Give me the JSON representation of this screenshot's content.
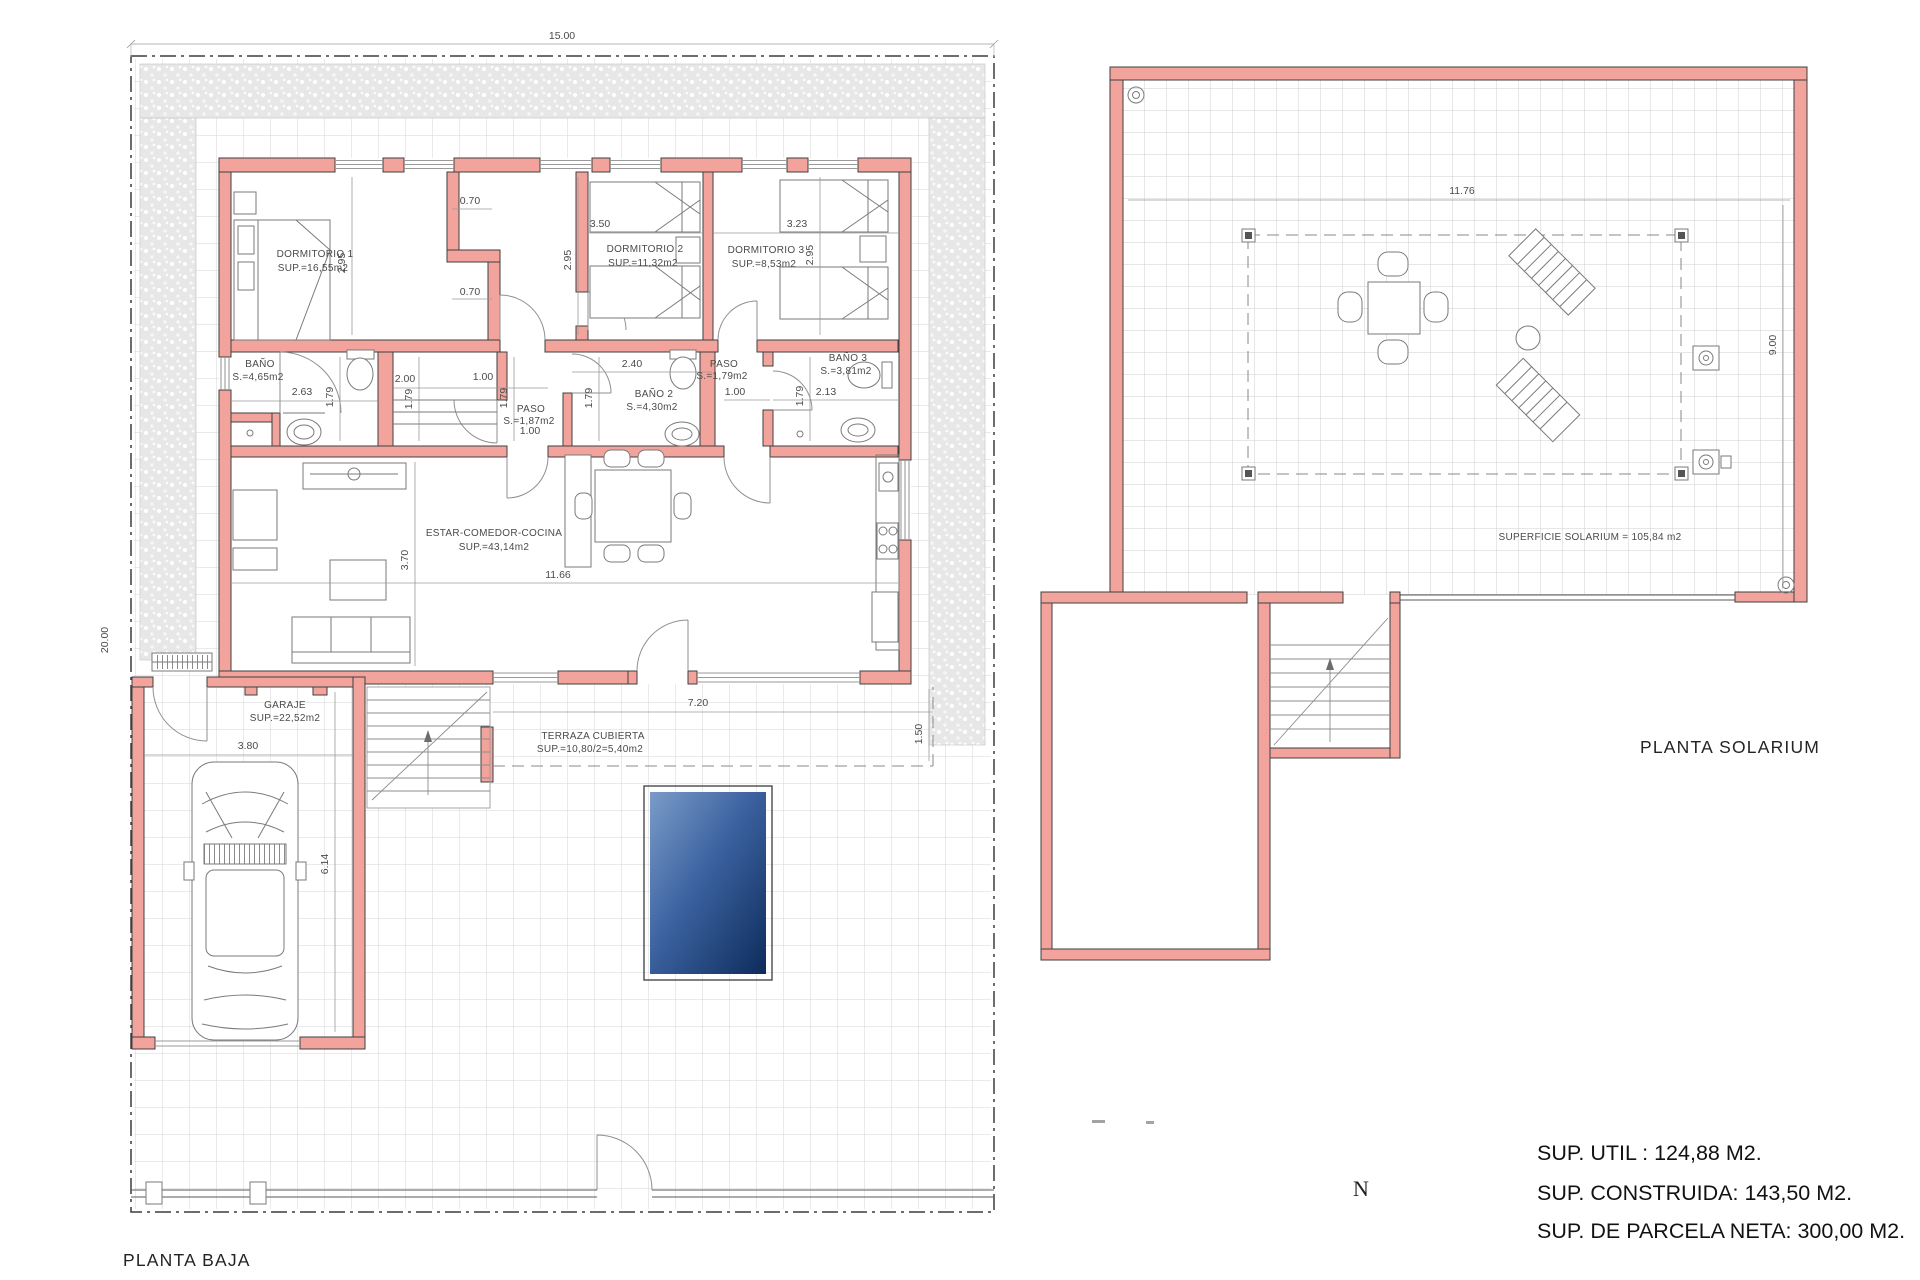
{
  "baja": {
    "title": "PLANTA BAJA",
    "rooms": {
      "dormitorio1": {
        "name": "DORMITORIO 1",
        "area": "SUP.=16,55m2"
      },
      "dormitorio2": {
        "name": "DORMITORIO 2",
        "area": "SUP.=11,32m2"
      },
      "dormitorio3": {
        "name": "DORMITORIO 3",
        "area": "SUP.=8,53m2"
      },
      "bano1": {
        "name": "BAÑO",
        "area": "S.=4,65m2"
      },
      "bano2": {
        "name": "BAÑO 2",
        "area": "S.=4,30m2"
      },
      "bano3": {
        "name": "BAÑO 3",
        "area": "S.=3,81m2"
      },
      "paso1": {
        "name": "PASO",
        "area": "S.=1,87m2"
      },
      "paso2": {
        "name": "PASO",
        "area": "S.=1,79m2"
      },
      "estar": {
        "name": "ESTAR-COMEDOR-COCINA",
        "area": "SUP.=43,14m2"
      },
      "garaje": {
        "name": "GARAJE",
        "area": "SUP.=22,52m2"
      },
      "terraza": {
        "name": "TERRAZA CUBIERTA",
        "area": "SUP.=10,80/2=5,40m2"
      }
    },
    "dims": {
      "plot_width": "15.00",
      "plot_depth": "20.00",
      "closet_top": "0.70",
      "closet_bottom": "0.70",
      "dorm1_depth": "2.95",
      "dorm2_depth": "2.95",
      "dorm3_depth": "2.95",
      "dorm2_width": "3.50",
      "dorm3_width": "3.23",
      "bano1_width": "2.63",
      "bano1_depth": "1.79",
      "m_width": "2.00",
      "m_door": "1.00",
      "m_depth": "1.79",
      "paso1_width": "1.00",
      "paso1_depth": "1.79",
      "bano2_width": "2.40",
      "bano2_depth": "1.79",
      "paso2_width": "1.00",
      "paso2_depth": "1.79",
      "bano3_width": "2.13",
      "living_width": "11.66",
      "living_depth": "3.70",
      "terraza_width": "7.20",
      "terraza_depth": "1.50",
      "garaje_width": "3.80",
      "garaje_depth": "6.14"
    }
  },
  "solarium": {
    "title": "PLANTA SOLARIUM",
    "surface": "SUPERFICIE SOLARIUM = 105,84 m2",
    "dims": {
      "width": "11.76",
      "depth": "9.00"
    }
  },
  "summary": {
    "util": "SUP. UTIL : 124,88 M2.",
    "construida": "SUP. CONSTRUIDA: 143,50 M2.",
    "parcela": "SUP. DE PARCELA NETA: 300,00 M2."
  },
  "north": "N",
  "colors": {
    "wall_fill": "#f2a49c",
    "wall_stroke": "#3f3f3f",
    "pool_light": "#7b9cc9",
    "pool_dark": "#0d2c5b",
    "grid": "#d4d4d4"
  }
}
